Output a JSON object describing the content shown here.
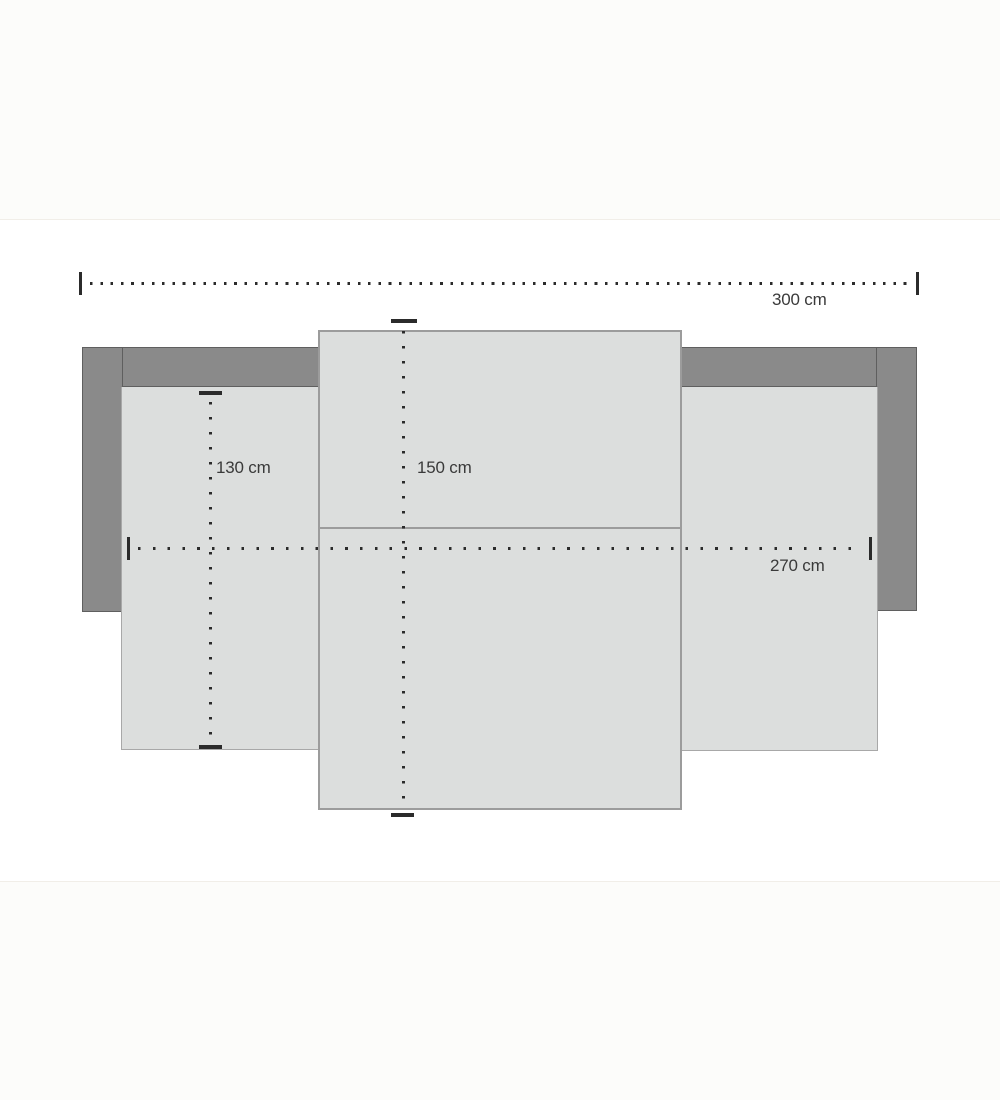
{
  "diagram": {
    "title": "sofa-bed top-view dimension drawing",
    "unit": "cm",
    "dimensions": {
      "total_width": {
        "label": "300 cm",
        "value": 300,
        "orientation": "horizontal"
      },
      "inner_width": {
        "label": "270 cm",
        "value": 270,
        "orientation": "horizontal"
      },
      "seat_depth": {
        "label": "130 cm",
        "value": 130,
        "orientation": "vertical"
      },
      "pullout_depth": {
        "label": "150 cm",
        "value": 150,
        "orientation": "vertical"
      }
    },
    "parts": {
      "backrest": "backrest band",
      "armrest_left": "left armrest",
      "armrest_right": "right armrest",
      "seat_left": "left seat cushion",
      "seat_right": "right seat cushion",
      "pullout": "pull-out bed section"
    },
    "colors": {
      "frame": "#8a8a8a",
      "frame_outline": "#5f5f5f",
      "cushion": "#dcdedd",
      "cushion_border": "#a8a8a8",
      "dimension_line": "#2b2b2b",
      "label_text": "#3a3a3a",
      "canvas": "#ffffff",
      "page_background": "#fcfcfa"
    }
  }
}
